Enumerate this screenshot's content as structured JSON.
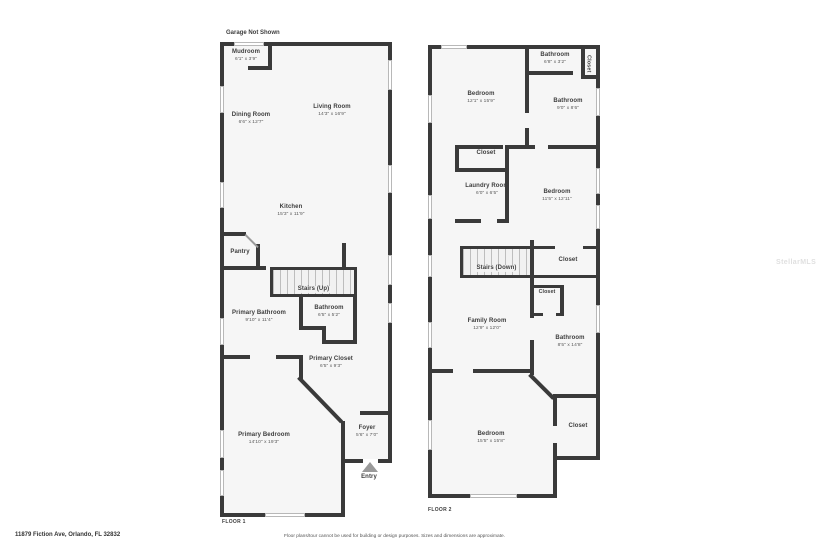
{
  "page": {
    "garage_note": "Garage Not Shown",
    "address": "11879 Fiction Ave, Orlando, FL 32832",
    "disclaimer": "Floor plans/tour cannot be used for building or design purposes. Sizes and dimensions are approximate.",
    "watermark": "StellarMLS"
  },
  "colors": {
    "wall": "#3a3a3a",
    "room_fill": "#f6f6f6",
    "room_name_text": "#3d3d3d",
    "dims_text": "#575757",
    "entry_arrow": "#9a9a9a"
  },
  "floor1": {
    "label": "FLOOR 1",
    "rooms": {
      "mudroom": {
        "name": "Mudroom",
        "dims": "6'1\" x 3'9\""
      },
      "dining": {
        "name": "Dining Room",
        "dims": "6'6\" x 12'7\""
      },
      "living": {
        "name": "Living Room",
        "dims": "14'3\" x 16'9\""
      },
      "kitchen": {
        "name": "Kitchen",
        "dims": "15'3\" x 11'9\""
      },
      "pantry": {
        "name": "Pantry",
        "dims": ""
      },
      "stairs": {
        "name": "Stairs (Up)",
        "dims": ""
      },
      "primary_bathroom": {
        "name": "Primary Bathroom",
        "dims": "9'10\" x 11'4\""
      },
      "bathroom": {
        "name": "Bathroom",
        "dims": "6'5\" x 5'2\""
      },
      "primary_closet": {
        "name": "Primary Closet",
        "dims": "6'5\" x 9'3\""
      },
      "primary_bedroom": {
        "name": "Primary Bedroom",
        "dims": "14'10\" x 19'3\""
      },
      "foyer": {
        "name": "Foyer",
        "dims": "5'6\" x 7'0\""
      },
      "entry": {
        "name": "Entry",
        "dims": ""
      }
    }
  },
  "floor2": {
    "label": "FLOOR 2",
    "rooms": {
      "bathroom_top": {
        "name": "Bathroom",
        "dims": "6'8\" x 3'2\""
      },
      "closet_top": {
        "name": "Closet",
        "dims": ""
      },
      "bedroom_upleft": {
        "name": "Bedroom",
        "dims": "12'1\" x 15'9\""
      },
      "bathroom_mid": {
        "name": "Bathroom",
        "dims": "9'0\" x 8'6\""
      },
      "closet_mid": {
        "name": "Closet",
        "dims": ""
      },
      "laundry": {
        "name": "Laundry Room",
        "dims": "6'0\" x 6'5\""
      },
      "bedroom_mid": {
        "name": "Bedroom",
        "dims": "11'5\" x 12'11\""
      },
      "stairs": {
        "name": "Stairs (Down)",
        "dims": ""
      },
      "closet_stairs": {
        "name": "Closet",
        "dims": ""
      },
      "closet_small": {
        "name": "Closet",
        "dims": ""
      },
      "family": {
        "name": "Family Room",
        "dims": "12'9\" x 12'0\""
      },
      "bathroom_low": {
        "name": "Bathroom",
        "dims": "8'5\" x 14'8\""
      },
      "bedroom_bottom": {
        "name": "Bedroom",
        "dims": "15'5\" x 15'8\""
      },
      "closet_bottom": {
        "name": "Closet",
        "dims": ""
      }
    }
  }
}
